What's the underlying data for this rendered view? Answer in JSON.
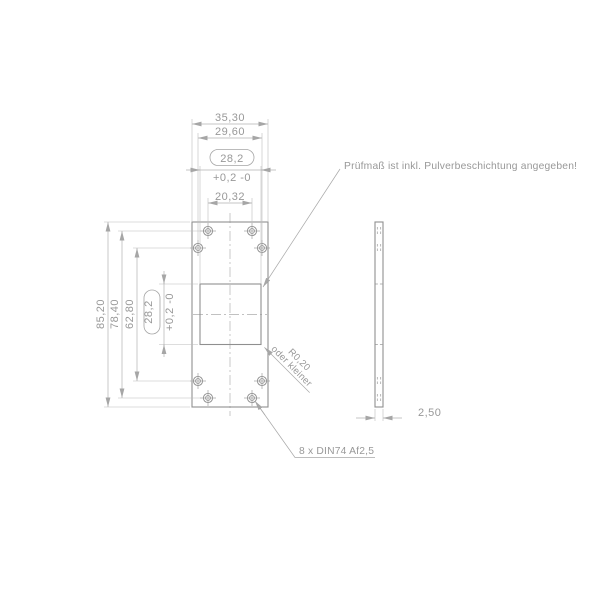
{
  "drawing": {
    "note_top": "Prüfmaß ist inkl. Pulverbeschichtung angegeben!",
    "holes_note": "8 x DIN74 Af2,5",
    "radius_note_line1": "R0,20",
    "radius_note_line2": "oder kleiner",
    "dims": {
      "width_overall": "35,30",
      "width_outer_holes": "29,60",
      "cutout_width": "28,2",
      "cutout_width_tol": "+0,2 -0",
      "width_inner_holes": "20,32",
      "height_overall": "85,20",
      "height_inner_holes": "78,40",
      "height_outer_holes": "62,80",
      "cutout_height": "28,2",
      "cutout_height_tol": "+0,2 -0",
      "thickness": "2,50"
    }
  }
}
